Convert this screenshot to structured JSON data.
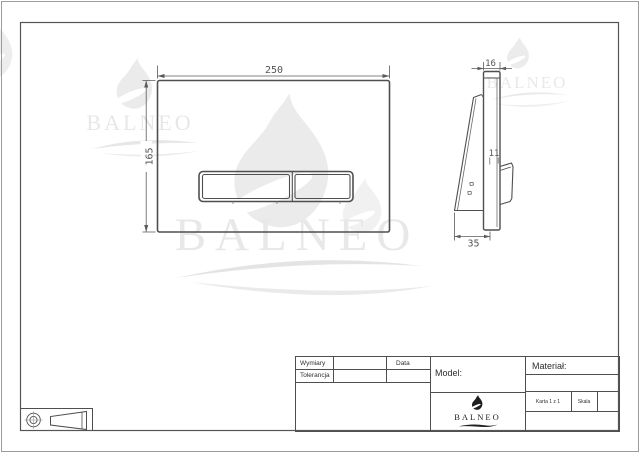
{
  "views": {
    "front": {
      "width_mm": "250",
      "height_mm": "165"
    },
    "side": {
      "thickness_mm": "16",
      "button_depth_mm": "11",
      "base_depth_mm": "35"
    }
  },
  "brand": {
    "name": "BALNEO"
  },
  "title_block": {
    "dimensions_label": "Wymiary",
    "tolerance_label": "Tolerancja",
    "date_label": "Data",
    "model_label": "Model:",
    "material_label": "Materiał:",
    "sheet_label": "Karta 1 z 1",
    "scale_label": "Skala",
    "logo": "BALNEO"
  }
}
